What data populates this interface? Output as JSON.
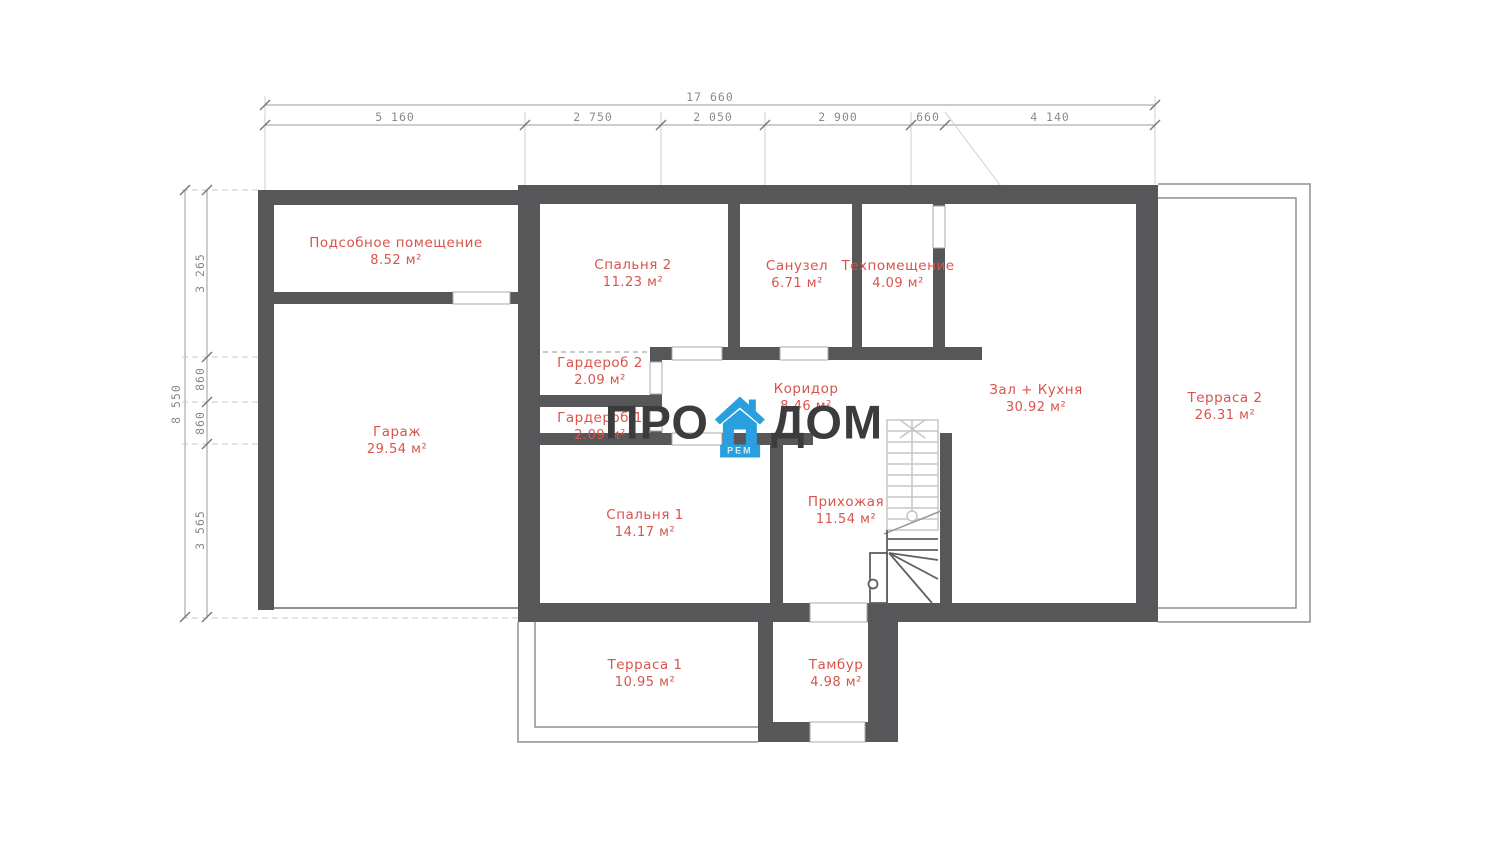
{
  "logo": {
    "left": "ПРО",
    "right": "ДОМ",
    "badge": "РЕМ"
  },
  "dimensions": {
    "top_total": "17 660",
    "top_segments": [
      "5 160",
      "2 750",
      "2 050",
      "2 900",
      "660",
      "4 140"
    ],
    "left_total": "8 550",
    "left_segments": [
      "3 265",
      "860",
      "860",
      "3 565"
    ]
  },
  "rooms": [
    {
      "name": "Подсобное помещение",
      "area": "8.52 м²"
    },
    {
      "name": "Спальня 2",
      "area": "11.23 м²"
    },
    {
      "name": "Санузел",
      "area": "6.71 м²"
    },
    {
      "name": "Техпомещение",
      "area": "4.09 м²"
    },
    {
      "name": "Гардероб 2",
      "area": "2.09 м²"
    },
    {
      "name": "Гардероб 1",
      "area": "2.09 м²"
    },
    {
      "name": "Коридор",
      "area": "8.46 м²"
    },
    {
      "name": "Гараж",
      "area": "29.54 м²"
    },
    {
      "name": "Зал + Кухня",
      "area": "30.92 м²"
    },
    {
      "name": "Терраса 2",
      "area": "26.31 м²"
    },
    {
      "name": "Спальня 1",
      "area": "14.17 м²"
    },
    {
      "name": "Прихожая",
      "area": "11.54 м²"
    },
    {
      "name": "Терраса 1",
      "area": "10.95 м²"
    },
    {
      "name": "Тамбур",
      "area": "4.98 м²"
    }
  ],
  "colors": {
    "wall": "#57575a",
    "label": "#d9544a",
    "dim": "#8a8a8a",
    "logo_text": "#3c3c3c",
    "logo_house": "#2a9fe0"
  }
}
